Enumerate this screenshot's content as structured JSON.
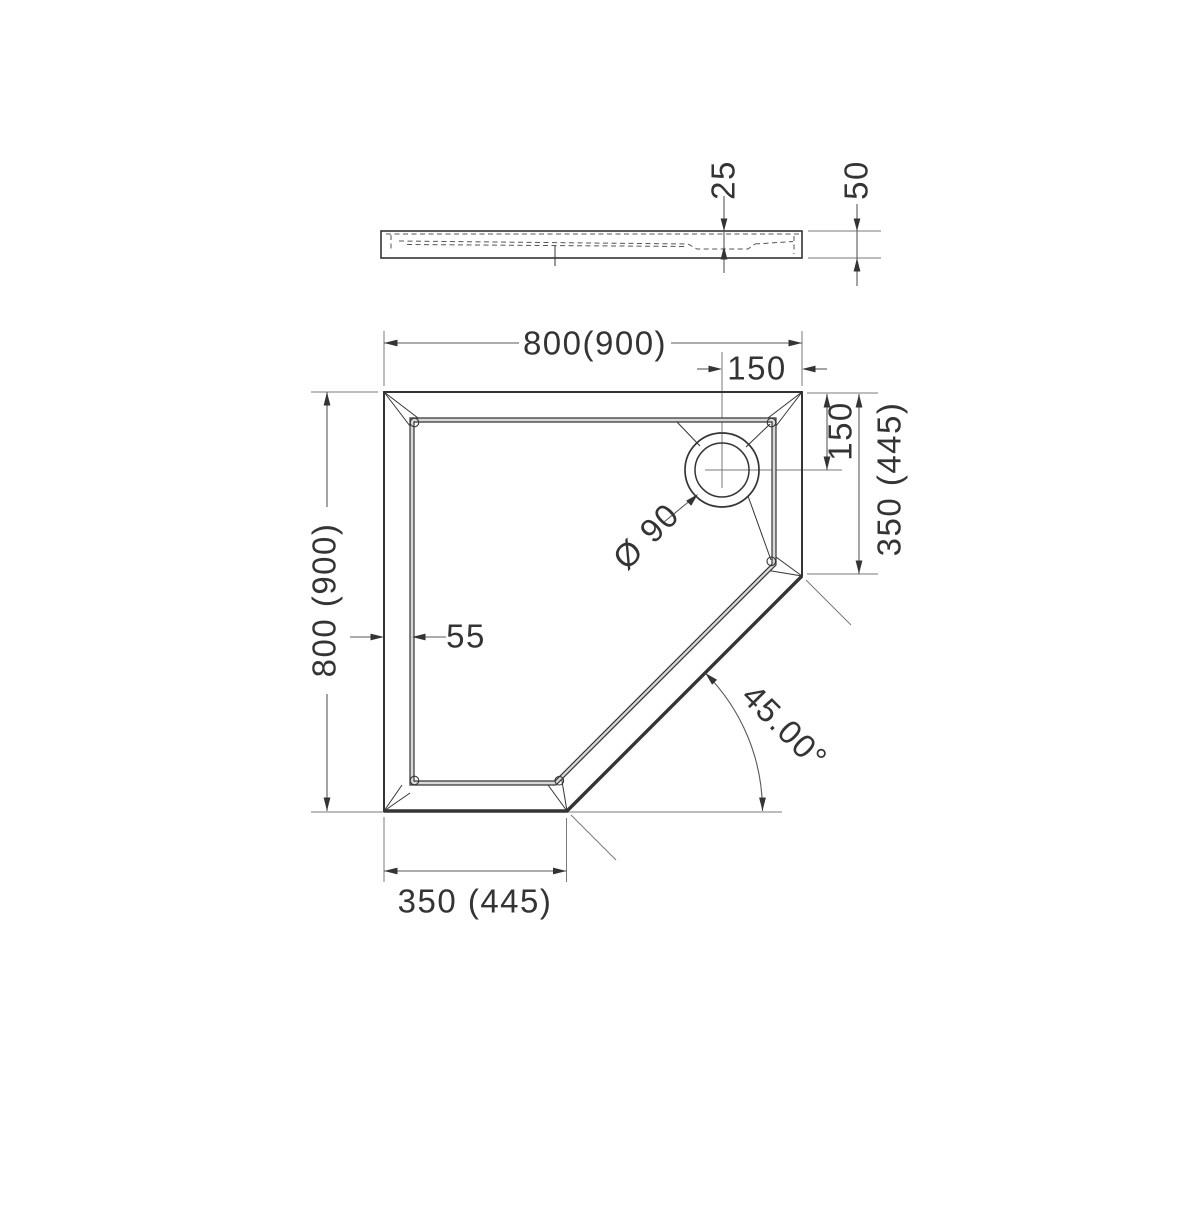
{
  "side_view": {
    "recess_depth": "25",
    "overall_height": "50"
  },
  "plan_view": {
    "width_top": "800(900)",
    "drain_offset_x": "150",
    "drain_offset_y": "150",
    "right_edge_length": "350 (445)",
    "height_left": "800 (900)",
    "rim_width": "55",
    "drain_diameter": "Ø 90",
    "corner_angle": "45.00°",
    "bottom_edge_length": "350 (445)"
  },
  "colors": {
    "line": "#343434",
    "thin_line": "#787878",
    "background": "#ffffff"
  }
}
